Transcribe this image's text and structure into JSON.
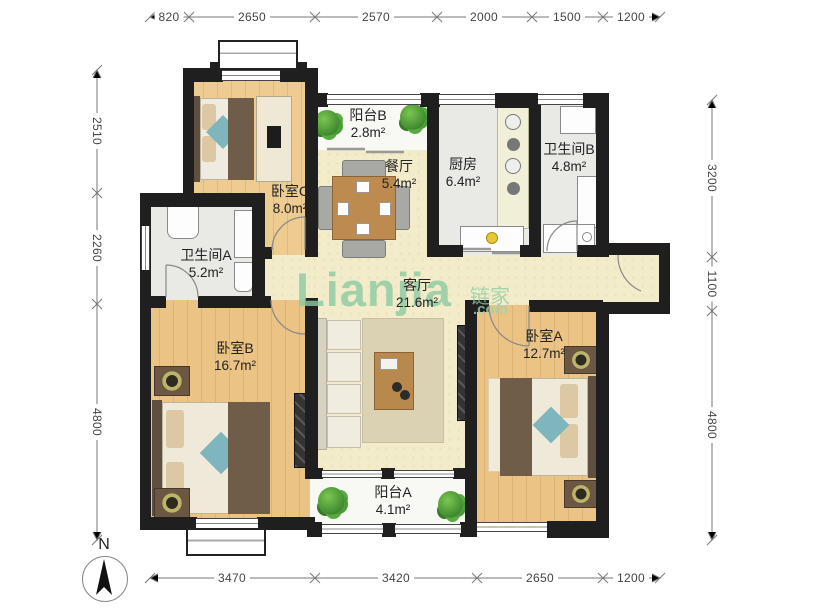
{
  "watermark": {
    "brand": "Lianjia",
    "brand_cn": "链家",
    "suffix": ".com"
  },
  "compass": {
    "north_label": "N"
  },
  "rooms": [
    {
      "id": "bedroom-c",
      "name": "卧室C",
      "area": "8.0m²"
    },
    {
      "id": "balcony-b",
      "name": "阳台B",
      "area": "2.8m²"
    },
    {
      "id": "dining",
      "name": "餐厅",
      "area": "5.4m²"
    },
    {
      "id": "kitchen",
      "name": "厨房",
      "area": "6.4m²"
    },
    {
      "id": "bathroom-b",
      "name": "卫生间B",
      "area": "4.8m²"
    },
    {
      "id": "bathroom-a",
      "name": "卫生间A",
      "area": "5.2m²"
    },
    {
      "id": "living",
      "name": "客厅",
      "area": "21.6m²"
    },
    {
      "id": "bedroom-b",
      "name": "卧室B",
      "area": "16.7m²"
    },
    {
      "id": "bedroom-a",
      "name": "卧室A",
      "area": "12.7m²"
    },
    {
      "id": "balcony-a",
      "name": "阳台A",
      "area": "4.1m²"
    }
  ],
  "dimensions": {
    "top": [
      "820",
      "2650",
      "2570",
      "2000",
      "1500",
      "1200"
    ],
    "bottom": [
      "3470",
      "3420",
      "2650",
      "1200"
    ],
    "left": [
      "2510",
      "2260",
      "4800"
    ],
    "right": [
      "3200",
      "1100",
      "4800"
    ]
  },
  "colors": {
    "wall": "#1f1f1f",
    "wood_floor": "#ebc385",
    "tile_floor": "#e9e9e5",
    "living_floor": "#f2ecca",
    "balcony_floor": "#f8f8f5",
    "watermark_green": "#8ccba3",
    "plant_green": "#4a9c38",
    "accent_teal": "#7fb5bd"
  }
}
